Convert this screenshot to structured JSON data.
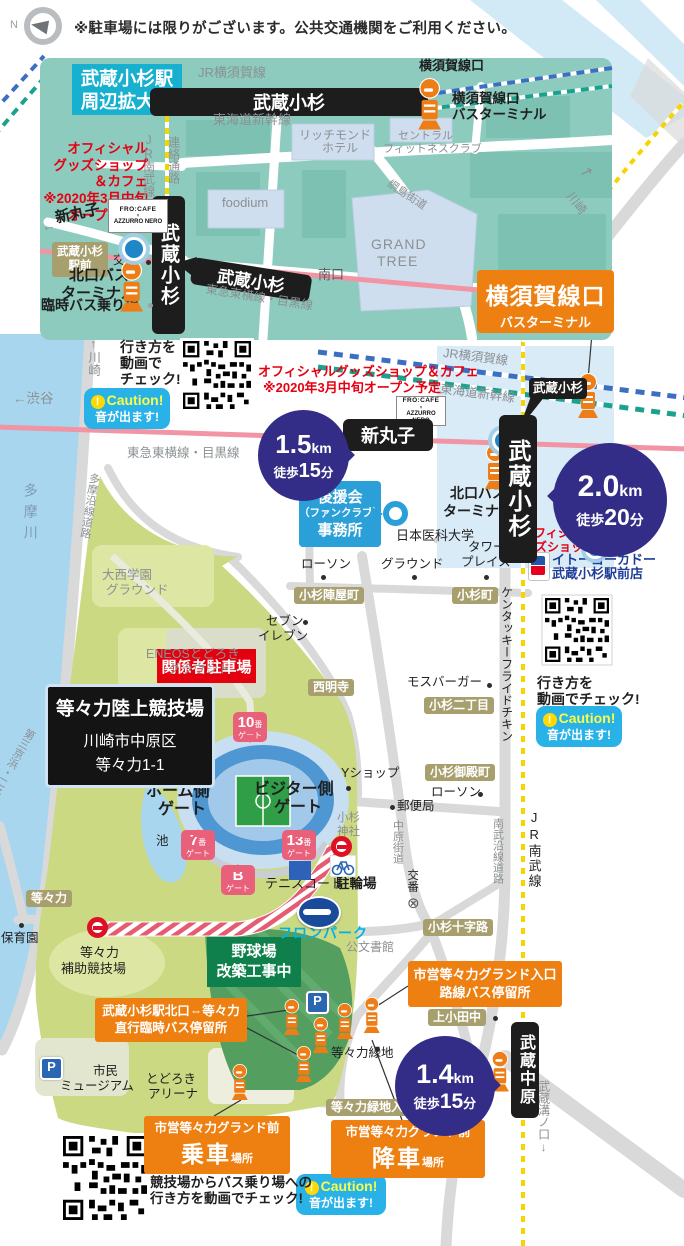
{
  "meta": {
    "notice": "※駐車場には限りがございます。公共交通機関をご利用ください。",
    "compass": "N",
    "p_label": "P"
  },
  "palette": {
    "accent_orange": "#ee7f11",
    "navy": "#332d87",
    "inset_bg": "#8ccbbd",
    "park": "#ccd983",
    "cyan_title": "#17b0cf",
    "rail_pink": "#f195a5",
    "rail_blue": "#3c6fc2",
    "rail_green": "#1ba28e",
    "rail_yellow": "#f5d400",
    "caution_bg": "#29b2e8"
  },
  "inset": {
    "title": [
      "武蔵小杉駅",
      "周辺拡大図"
    ],
    "goods_note": [
      "オフィシャル",
      "グッズショップ",
      "＆カフェ",
      "※2020年3月中旬",
      "オープン予定"
    ],
    "bars": {
      "top": "武蔵小杉",
      "vert": "武蔵小杉",
      "tokyu": "武蔵小杉"
    },
    "ekimae": [
      "武蔵小杉",
      "駅前"
    ],
    "frocafe": [
      "FRO:CAFE",
      "×",
      "AZZURRO NERO"
    ],
    "labels": [
      {
        "t": "JR横須賀線",
        "x": 198,
        "y": 66,
        "c": "g",
        "s": 13
      },
      {
        "t": "東海道新幹線",
        "x": 213,
        "y": 113,
        "c": "g",
        "s": 13
      },
      {
        "t": "JR南武線",
        "x": 142,
        "y": 133,
        "v": 1,
        "c": "g",
        "s": 12
      },
      {
        "t": "連絡通路",
        "x": 167,
        "y": 136,
        "v": 1,
        "c": "g",
        "s": 12
      },
      {
        "t": "リッチモンド",
        "x": 299,
        "y": 129,
        "c": "g",
        "s": 12
      },
      {
        "t": "ホテル",
        "x": 322,
        "y": 142,
        "c": "g",
        "s": 12
      },
      {
        "t": "セントラル",
        "x": 398,
        "y": 131,
        "c": "g",
        "s": 11
      },
      {
        "t": "フィットネスクラブ",
        "x": 383,
        "y": 144,
        "c": "g",
        "s": 11
      },
      {
        "t": "foodium",
        "x": 222,
        "y": 196,
        "c": "g",
        "s": 13
      },
      {
        "t": "GRAND",
        "x": 371,
        "y": 237,
        "c": "g",
        "s": 14,
        "sp": 1
      },
      {
        "t": "TREE",
        "x": 377,
        "y": 254,
        "c": "g",
        "s": 14,
        "sp": 1
      },
      {
        "t": "綱島街道",
        "x": 391,
        "y": 179,
        "c": "g",
        "s": 11,
        "r": 33
      },
      {
        "t": "横須賀線口",
        "x": 419,
        "y": 59,
        "b": 1,
        "s": 13
      },
      {
        "t": "横須賀線口",
        "x": 452,
        "y": 92,
        "b": 1,
        "s": 13.5
      },
      {
        "t": "バスターミナル",
        "x": 452,
        "y": 108,
        "b": 1,
        "s": 13.5
      },
      {
        "t": "南口",
        "x": 318,
        "y": 268,
        "c": "d",
        "s": 13
      },
      {
        "t": "←",
        "x": 40,
        "y": 220,
        "c": "g",
        "s": 14,
        "r": -12
      },
      {
        "t": "新丸子",
        "x": 54,
        "y": 211,
        "b": 1,
        "s": 15,
        "r": -12
      },
      {
        "t": "交番",
        "x": 113,
        "y": 254,
        "s": 12
      },
      {
        "t": "北口バス",
        "x": 69,
        "y": 268,
        "b": 1,
        "s": 15
      },
      {
        "t": "ターミナル",
        "x": 61,
        "y": 286,
        "b": 1,
        "s": 15
      },
      {
        "t": "臨時バス乗り場",
        "x": 41,
        "y": 298,
        "b": 1,
        "s": 14
      },
      {
        "t": "東急東横線・目黒線",
        "x": 207,
        "y": 283,
        "c": "g",
        "s": 12,
        "r": 9
      }
    ]
  },
  "main": {
    "stations": {
      "shinmaruko": "新丸子",
      "musashikosugi": "武蔵小杉",
      "bubble": "武蔵小杉",
      "musashinakahara": "武蔵中原"
    },
    "terminal": {
      "l1": "横須賀線口",
      "l2": "バスターミナル"
    },
    "distance": [
      {
        "num": "1.5",
        "unit": "km",
        "pre": "徒歩",
        "min": "15",
        "suf": "分"
      },
      {
        "num": "2.0",
        "unit": "km",
        "pre": "徒歩",
        "min": "20",
        "suf": "分"
      },
      {
        "num": "1.4",
        "unit": "km",
        "pre": "徒歩",
        "min": "15",
        "suf": "分"
      }
    ],
    "stadium_box": {
      "title": "等々力陸上競技場",
      "addr1": "川崎市中原区",
      "addr2": "等々力1-1"
    },
    "kankei": "関係者駐車場",
    "yakyu": [
      "野球場",
      "改築工事中"
    ],
    "fanclub": [
      "後援会",
      "（ファンクラブ）",
      "事務所"
    ],
    "bus_boxes": [
      {
        "l1": "武蔵小杉駅北口⇔等々力",
        "l2": "直行臨時バス停留所"
      },
      {
        "l1": "市営等々力グランド入口",
        "l2": "路線バス停留所"
      },
      {
        "l1": "市営等々力グランド前",
        "big": "乗車",
        "sm": "場所"
      },
      {
        "l1": "市営等々力グランド前",
        "big": "降車",
        "sm": "場所"
      }
    ],
    "caution": {
      "bang": "!",
      "head": "Caution!",
      "body": "音が出ます!"
    },
    "gates": {
      "word": "ゲート",
      "badges": [
        {
          "n": "10",
          "sub": "番",
          "x": 233,
          "y": 712,
          "tail": "b"
        },
        {
          "n": "7",
          "sub": "番",
          "x": 181,
          "y": 830,
          "tail": "t"
        },
        {
          "n": "13",
          "sub": "番",
          "x": 282,
          "y": 830,
          "tail": "t"
        },
        {
          "n": "B",
          "sub": "",
          "x": 221,
          "y": 865,
          "tail": "t"
        }
      ]
    },
    "labels": [
      {
        "t": "↑川崎",
        "x": 86,
        "y": 337,
        "v": 1,
        "c": "g",
        "s": 12.5
      },
      {
        "t": "行き方を",
        "x": 120,
        "y": 340,
        "b": 1,
        "s": 14
      },
      {
        "t": "動画で",
        "x": 120,
        "y": 356,
        "b": 1,
        "s": 14
      },
      {
        "t": "チェック!",
        "x": 120,
        "y": 372,
        "b": 1,
        "s": 14
      },
      {
        "t": "オフィシャルグッズショップ＆カフェ",
        "x": 258,
        "y": 365,
        "c": "r",
        "b": 1,
        "s": 13
      },
      {
        "t": "※2020年3月中旬オープン予定",
        "x": 263,
        "y": 381,
        "c": "r",
        "b": 1,
        "s": 13
      },
      {
        "t": "←渋谷",
        "x": 13,
        "y": 392,
        "c": "g",
        "s": 13.5
      },
      {
        "t": "東急東横線・目黒線",
        "x": 127,
        "y": 447,
        "c": "g",
        "s": 12.5
      },
      {
        "t": "JR横須賀線",
        "x": 444,
        "y": 347,
        "c": "g",
        "s": 12.5,
        "r": 7
      },
      {
        "t": "東海道新幹線",
        "x": 441,
        "y": 383,
        "c": "g",
        "s": 12.5,
        "r": 7
      },
      {
        "t": "川崎",
        "x": 574,
        "y": 190,
        "c": "g",
        "s": 12,
        "r": 52
      },
      {
        "t": "↗",
        "x": 583,
        "y": 163,
        "c": "g",
        "s": 15,
        "r": 20
      },
      {
        "t": "北口バス",
        "x": 450,
        "y": 486,
        "b": 1,
        "s": 14
      },
      {
        "t": "ターミナル",
        "x": 443,
        "y": 504,
        "b": 1,
        "s": 14
      },
      {
        "t": "日本医科大学",
        "x": 396,
        "y": 529,
        "s": 13
      },
      {
        "t": "ローソン",
        "x": 301,
        "y": 558,
        "s": 12.5
      },
      {
        "t": "グラウンド",
        "x": 381,
        "y": 558,
        "s": 12.5
      },
      {
        "t": "タワー",
        "x": 468,
        "y": 541,
        "s": 12.5
      },
      {
        "t": "プレイス",
        "x": 461,
        "y": 556,
        "s": 12.5
      },
      {
        "t": "オフィシャル",
        "x": 522,
        "y": 527,
        "c": "r",
        "b": 1,
        "s": 12
      },
      {
        "t": "グッズショップ",
        "x": 511,
        "y": 541,
        "c": "r",
        "b": 1,
        "s": 12
      },
      {
        "t": "イトーヨーカドー",
        "x": 552,
        "y": 553,
        "c": "bl",
        "b": 1,
        "s": 13
      },
      {
        "t": "武蔵小杉駅前店",
        "x": 552,
        "y": 567,
        "c": "bl",
        "b": 1,
        "s": 13
      },
      {
        "t": "セブン",
        "x": 266,
        "y": 615,
        "s": 12.5
      },
      {
        "t": "イレブン",
        "x": 258,
        "y": 630,
        "s": 12.5
      },
      {
        "t": "モスバーガー",
        "x": 407,
        "y": 676,
        "s": 12.5
      },
      {
        "t": "行き方を",
        "x": 537,
        "y": 676,
        "b": 1,
        "s": 14
      },
      {
        "t": "動画でチェック!",
        "x": 537,
        "y": 692,
        "b": 1,
        "s": 14
      },
      {
        "t": "ケンタッキーフライドチキン",
        "x": 500,
        "y": 586,
        "v": 1,
        "s": 12
      },
      {
        "t": "大西学園",
        "x": 102,
        "y": 569,
        "c": "g",
        "s": 12.5
      },
      {
        "t": "グラウンド",
        "x": 106,
        "y": 584,
        "c": "g",
        "s": 12.5
      },
      {
        "t": "ENEOSとどろき",
        "x": 146,
        "y": 648,
        "c": "g",
        "s": 12.5
      },
      {
        "t": "グラウンド",
        "x": 168,
        "y": 663,
        "c": "g",
        "s": 12.5
      },
      {
        "t": "Yショップ",
        "x": 341,
        "y": 767,
        "s": 12.5
      },
      {
        "t": "郵便局",
        "x": 397,
        "y": 800,
        "s": 12.5
      },
      {
        "t": "小杉",
        "x": 337,
        "y": 812,
        "c": "g",
        "s": 11.5
      },
      {
        "t": "神社",
        "x": 337,
        "y": 826,
        "c": "g",
        "s": 11.5
      },
      {
        "t": "ローソン",
        "x": 431,
        "y": 786,
        "s": 12.5
      },
      {
        "t": "中原街道",
        "x": 391,
        "y": 820,
        "v": 1,
        "c": "g",
        "s": 11
      },
      {
        "t": "交番",
        "x": 406,
        "y": 869,
        "v": 1,
        "s": 11.5
      },
      {
        "t": "⊗",
        "x": 407,
        "y": 896,
        "c": "d",
        "s": 15
      },
      {
        "t": "公文書館",
        "x": 346,
        "y": 941,
        "c": "g",
        "s": 12
      },
      {
        "t": "等々力緑地",
        "x": 331,
        "y": 1047,
        "s": 12.5
      },
      {
        "t": "南武沿線道路",
        "x": 491,
        "y": 818,
        "v": 1,
        "c": "g",
        "s": 11
      },
      {
        "t": "JR南武線",
        "x": 527,
        "y": 810,
        "v": 1,
        "s": 13,
        "sp": 2
      },
      {
        "t": "第三京浜↓",
        "x": 469,
        "y": 1094,
        "v": 1,
        "c": "g",
        "s": 12
      },
      {
        "t": "武蔵溝ノ口↓",
        "x": 537,
        "y": 1080,
        "v": 1,
        "c": "g",
        "s": 12
      },
      {
        "t": "多摩川",
        "x": 23,
        "y": 483,
        "v": 1,
        "c": "riv",
        "s": 14,
        "sp": 7
      },
      {
        "t": "多摩沿線道路",
        "x": 88,
        "y": 472,
        "v": 1,
        "c": "g",
        "s": 11,
        "r": 9
      },
      {
        "t": "第三京浜・二子橋↓",
        "x": 26,
        "y": 726,
        "v": 1,
        "c": "g",
        "s": 11,
        "r": 30
      },
      {
        "t": "保育園",
        "x": 1,
        "y": 932,
        "s": 12.5
      },
      {
        "t": "等々力",
        "x": 80,
        "y": 946,
        "s": 13
      },
      {
        "t": "補助競技場",
        "x": 61,
        "y": 962,
        "s": 13
      },
      {
        "t": "市民",
        "x": 93,
        "y": 1065,
        "s": 12.5
      },
      {
        "t": "ミュージアム",
        "x": 60,
        "y": 1080,
        "s": 12.5
      },
      {
        "t": "とどろき",
        "x": 146,
        "y": 1073,
        "s": 12.5
      },
      {
        "t": "アリーナ",
        "x": 148,
        "y": 1088,
        "s": 12.5
      },
      {
        "t": "池",
        "x": 156,
        "y": 835,
        "s": 12.5
      },
      {
        "t": "ホーム側",
        "x": 146,
        "y": 784,
        "b": 1,
        "s": 16
      },
      {
        "t": "ゲート",
        "x": 158,
        "y": 802,
        "b": 1,
        "s": 16
      },
      {
        "t": "ビジター側",
        "x": 254,
        "y": 782,
        "b": 1,
        "s": 16
      },
      {
        "t": "ゲート",
        "x": 274,
        "y": 800,
        "b": 1,
        "s": 16
      },
      {
        "t": "テニスコート",
        "x": 265,
        "y": 877,
        "s": 13
      },
      {
        "t": "駐輪場",
        "x": 336,
        "y": 877,
        "b": 1,
        "s": 13.5
      },
      {
        "t": "フロンパーク",
        "x": 278,
        "y": 926,
        "c": "cy",
        "b": 1,
        "s": 14,
        "sp": 1
      },
      {
        "t": "競技場からバス乗り場への",
        "x": 150,
        "y": 1176,
        "b": 1,
        "s": 13.5
      },
      {
        "t": "行き方を動画でチェック!",
        "x": 150,
        "y": 1192,
        "b": 1,
        "s": 13.5
      }
    ],
    "tan_boxes": [
      {
        "t": "小杉陣屋町",
        "x": 294,
        "y": 587
      },
      {
        "t": "小杉町",
        "x": 452,
        "y": 587
      },
      {
        "t": "西明寺",
        "x": 308,
        "y": 679
      },
      {
        "t": "小杉二丁目",
        "x": 424,
        "y": 697
      },
      {
        "t": "小杉御殿町",
        "x": 425,
        "y": 764
      },
      {
        "t": "小杉十字路",
        "x": 423,
        "y": 919
      },
      {
        "t": "上小田中",
        "x": 428,
        "y": 1009
      },
      {
        "t": "等々力",
        "x": 26,
        "y": 890
      },
      {
        "t": "等々力緑地入口",
        "x": 326,
        "y": 1099
      }
    ],
    "dots": [
      {
        "x": 321,
        "y": 575
      },
      {
        "x": 412,
        "y": 575
      },
      {
        "x": 484,
        "y": 575
      },
      {
        "x": 303,
        "y": 620
      },
      {
        "x": 487,
        "y": 683
      },
      {
        "x": 478,
        "y": 792
      },
      {
        "x": 390,
        "y": 805
      },
      {
        "x": 346,
        "y": 786
      },
      {
        "x": 19,
        "y": 923
      },
      {
        "x": 375,
        "y": 1047
      },
      {
        "x": 493,
        "y": 1016
      },
      {
        "x": 146,
        "y": 260
      },
      {
        "x": 148,
        "y": 303,
        "c": "#9aa0a3"
      }
    ],
    "bus_icons": [
      {
        "x": 417,
        "y": 78,
        "s": 1.15
      },
      {
        "x": 119,
        "y": 260,
        "s": 1.15
      },
      {
        "x": 577,
        "y": 373,
        "s": 1
      },
      {
        "x": 484,
        "y": 444,
        "s": 1
      },
      {
        "x": 283,
        "y": 999,
        "s": 0.8
      },
      {
        "x": 312,
        "y": 1017,
        "s": 0.8
      },
      {
        "x": 336,
        "y": 1003,
        "s": 0.8
      },
      {
        "x": 295,
        "y": 1046,
        "s": 0.8
      },
      {
        "x": 231,
        "y": 1064,
        "s": 0.8
      },
      {
        "x": 363,
        "y": 997,
        "s": 0.8
      },
      {
        "x": 490,
        "y": 1051,
        "s": 0.9
      }
    ],
    "p_icons": [
      {
        "x": 306,
        "y": 991
      },
      {
        "x": 40,
        "y": 1057
      }
    ],
    "no_entry": [
      {
        "x": 331,
        "y": 836
      },
      {
        "x": 87,
        "y": 917
      }
    ],
    "markers": [
      {
        "x": 122,
        "y": 237,
        "d": 18
      },
      {
        "x": 492,
        "y": 429,
        "d": 17
      },
      {
        "x": 585,
        "y": 539,
        "d": 14
      }
    ]
  }
}
